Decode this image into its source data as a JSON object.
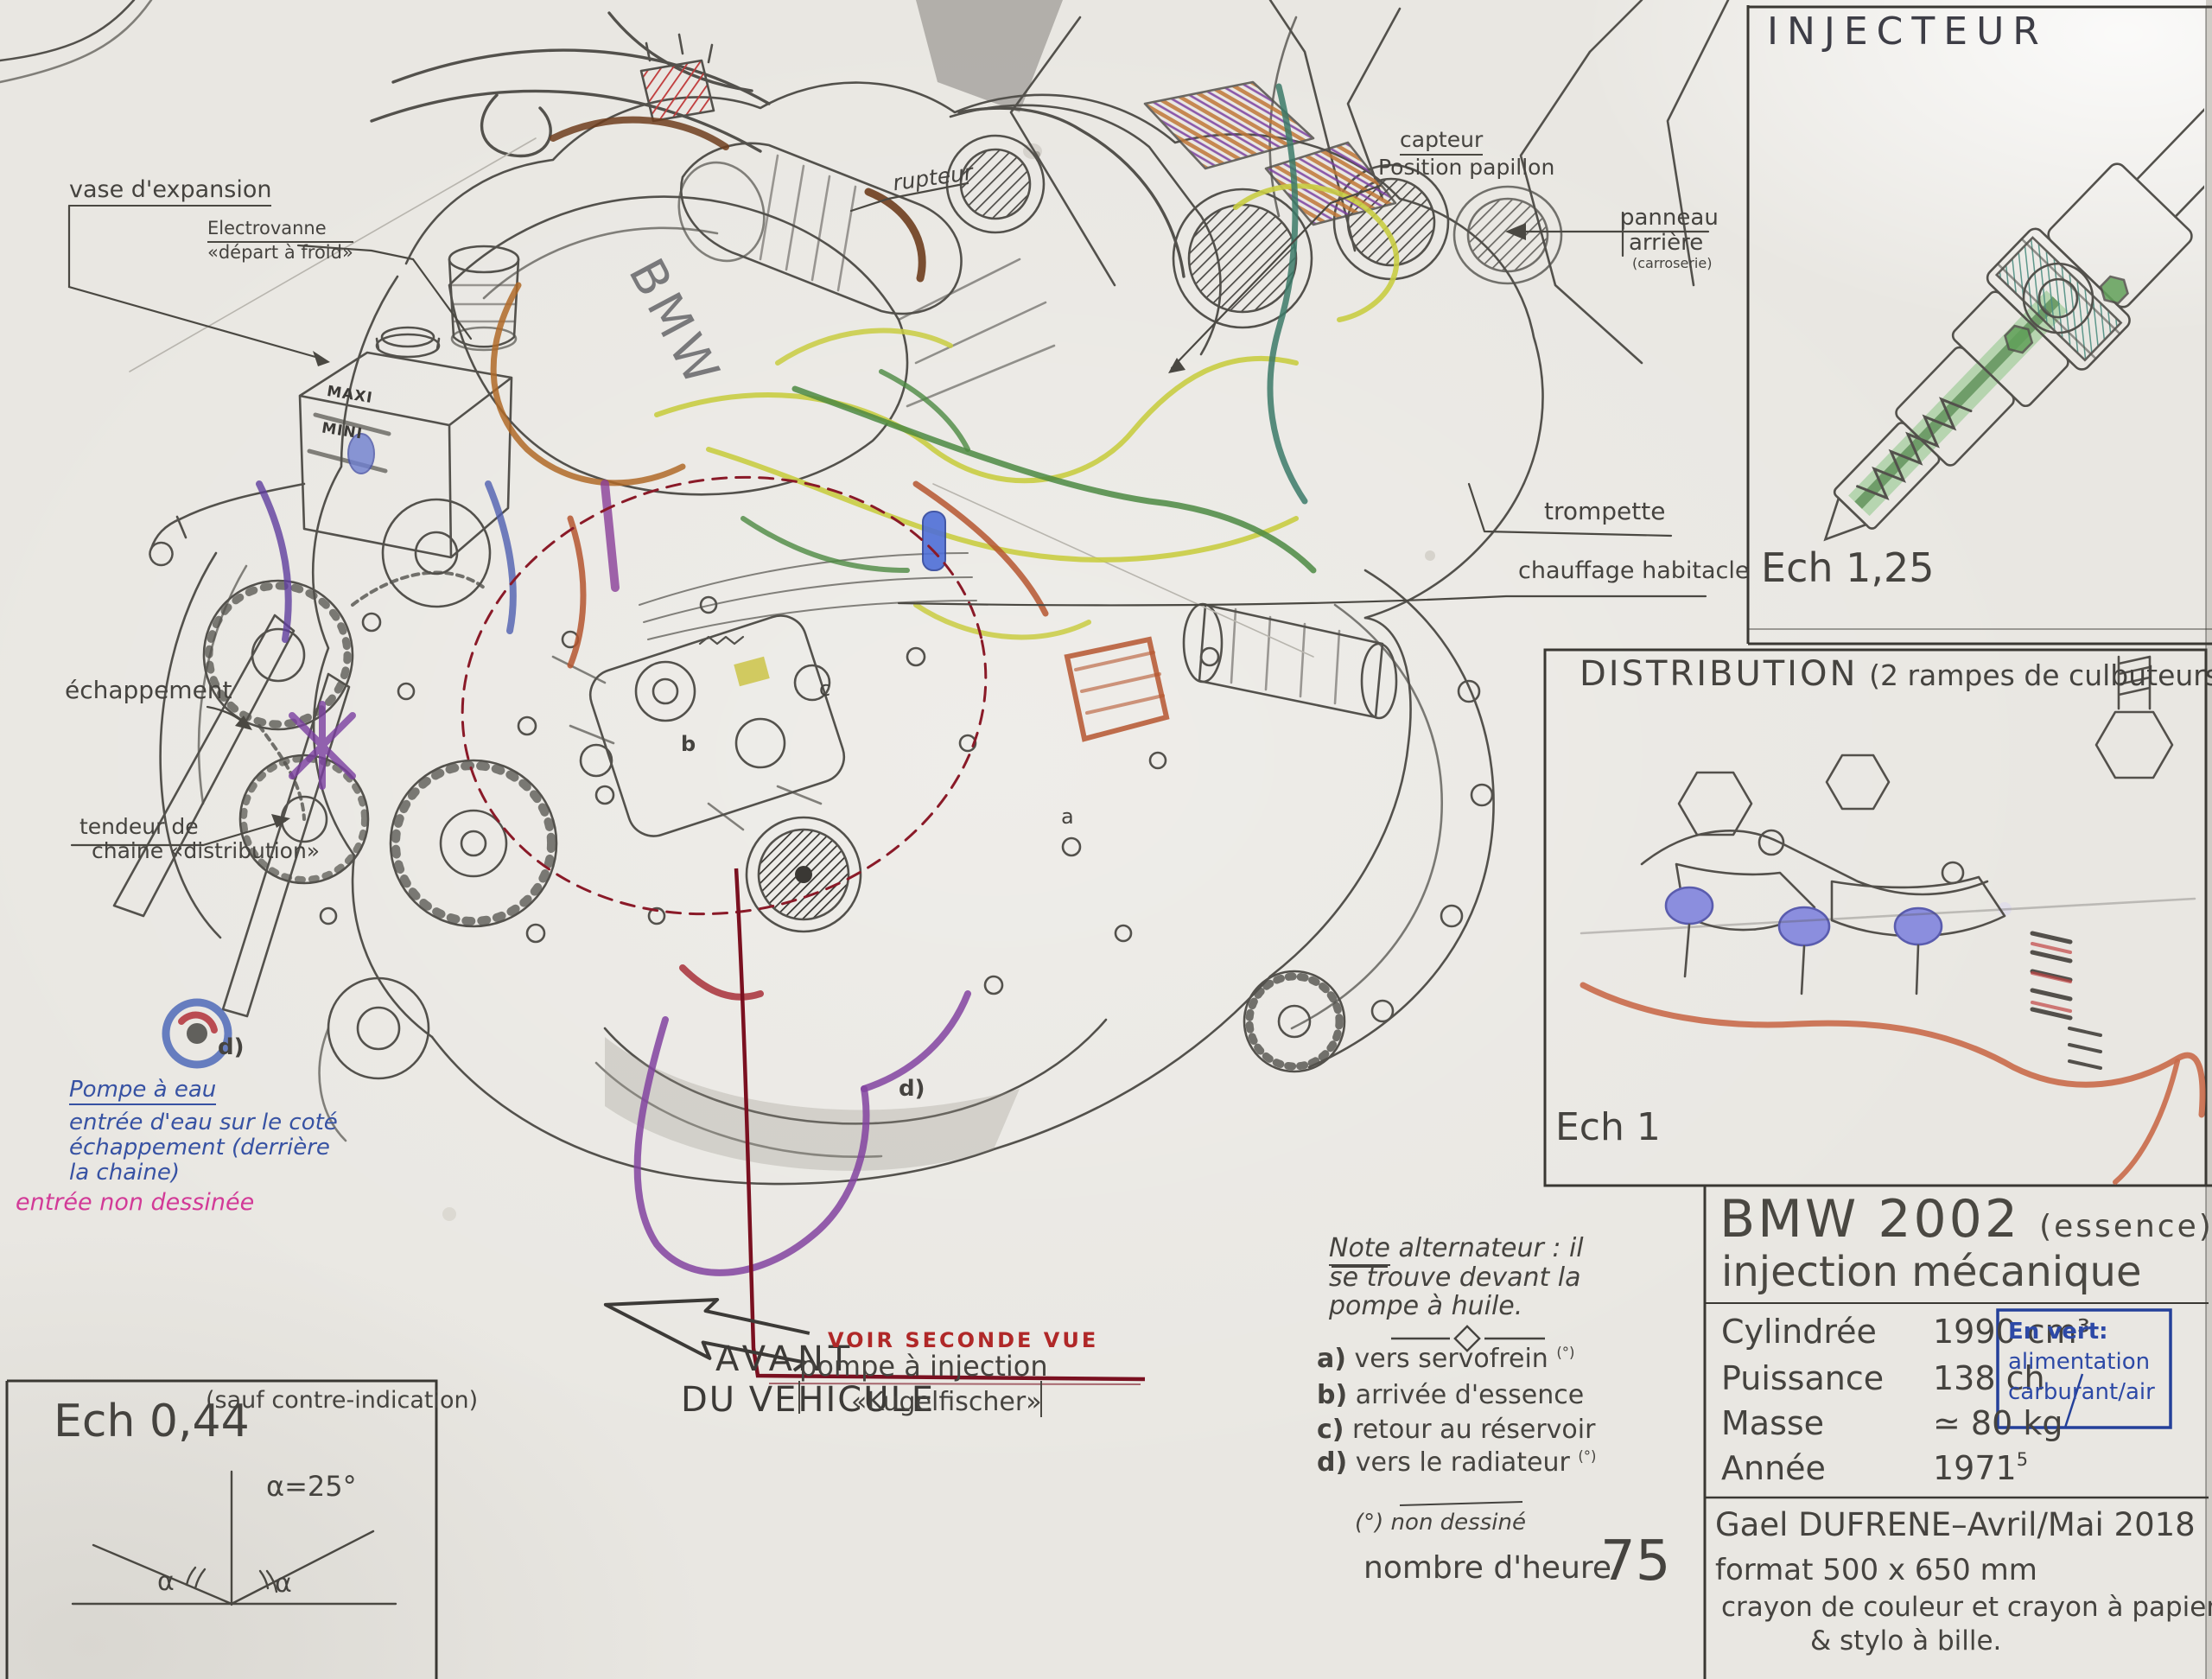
{
  "labels": {
    "vase": "vase d'expansion",
    "electro1": "Electrovanne",
    "electro2": "«départ à froid»",
    "rupteur": "rupteur",
    "capteur1": "capteur",
    "capteur2": "Position papillon",
    "panneau1": "panneau",
    "panneau2": "arrière",
    "panneau3": "(carroserie)",
    "trompette": "trompette",
    "chauffage": "chauffage habitacle",
    "echappement": "échappement",
    "tendeur1": "tendeur de",
    "tendeur2": "chaine «distribution»",
    "maxi": "MAXI",
    "mini": "MINI",
    "bmw_cover": "BMW"
  },
  "water_pump_note": {
    "l1": "Pompe à eau",
    "l2": "entrée d'eau sur le coté",
    "l3": "échappement (derrière",
    "l4": "la chaine)",
    "pink": "entrée non dessinée"
  },
  "front_arrow": {
    "l1": "AVANT",
    "l2": "DU VEHICULE"
  },
  "second_view": {
    "red": "VOIR SECONDE VUE",
    "l1": "pompe à injection",
    "l2": "«Kugelfischer»"
  },
  "markers": {
    "a": "a",
    "b": "b",
    "c": "c",
    "d_left": "d)",
    "d_center": "d)"
  },
  "injector_panel": {
    "title": "INJECTEUR",
    "scale": "Ech 1,25"
  },
  "distribution_panel": {
    "title": "DISTRIBUTION",
    "subtitle": "(2 rampes de culbuteurs)",
    "scale": "Ech 1"
  },
  "spec_panel": {
    "model": "BMW 2002",
    "fuel": "(essence)",
    "subtitle": "injection mécanique",
    "rows": [
      {
        "label": "Cylindrée",
        "value": "1990 cm³"
      },
      {
        "label": "Puissance",
        "value": "138 ch"
      },
      {
        "label": "Masse",
        "value": "≃ 80 kg"
      },
      {
        "label": "Année",
        "value": "1971"
      }
    ],
    "year_mark": "5",
    "green_note": {
      "l1": "En vert:",
      "l2": "alimentation",
      "l3": "carburant/air"
    }
  },
  "signature": {
    "l1": "Gael DUFRENE–Avril/Mai 2018",
    "l2": "format 500 x 650 mm",
    "l3": "crayon  de  couleur et  crayon à papier",
    "l4": "& stylo à bille."
  },
  "alternator_note": {
    "title": "Note",
    "rest": " alternateur : il",
    "l2": "se trouve devant la",
    "l3": "pompe à huile.",
    "items": [
      {
        "k": "a)",
        "t": "vers  servofrein ",
        "sup": "(°)"
      },
      {
        "k": "b)",
        "t": "arrivée d'essence",
        "sup": ""
      },
      {
        "k": "c)",
        "t": "retour au réservoir",
        "sup": ""
      },
      {
        "k": "d)",
        "t": "vers le radiateur ",
        "sup": "(°)"
      }
    ],
    "foot": "(°) non dessiné",
    "hours_label": "nombre d'heure",
    "hours_value": "75"
  },
  "scale_panel": {
    "title": "Ech 0,44",
    "paren": "(sauf contre-indication)",
    "alpha_eq": "α=25°",
    "alpha_l": "α",
    "alpha_r": "α"
  },
  "colors": {
    "pencil": "#45433f",
    "blue_ink": "#3752a3",
    "pink_ink": "#d23a97",
    "red_ink": "#b02828",
    "dark_red": "#7a1020",
    "green": "#4c8a42",
    "yellow": "#c9cd42",
    "orange": "#b5562f",
    "purple": "#8243a0"
  }
}
